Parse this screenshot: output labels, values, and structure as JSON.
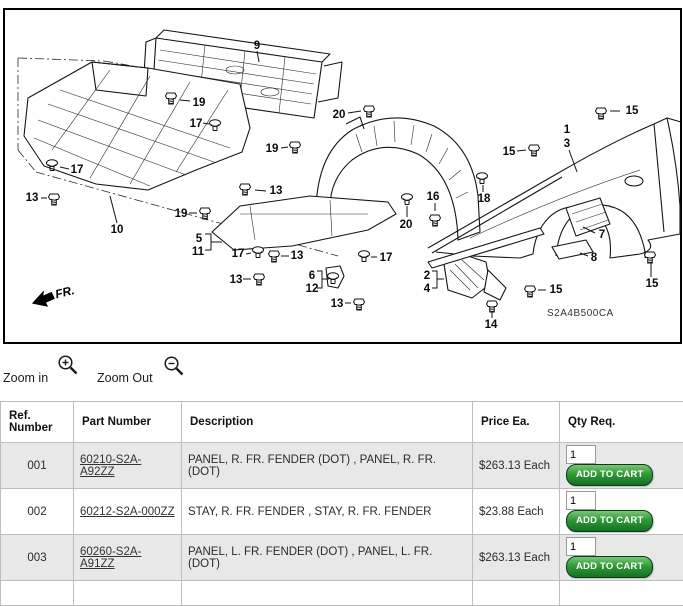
{
  "diagram": {
    "code": "S2A4B500CA",
    "fr_label": "FR.",
    "labels": [
      {
        "t": "9",
        "x": 257,
        "y": 46
      },
      {
        "t": "19",
        "x": 199,
        "y": 103
      },
      {
        "t": "17",
        "x": 196,
        "y": 124
      },
      {
        "t": "19",
        "x": 272,
        "y": 149
      },
      {
        "t": "20",
        "x": 339,
        "y": 115
      },
      {
        "t": "15",
        "x": 632,
        "y": 111
      },
      {
        "t": "15",
        "x": 509,
        "y": 152
      },
      {
        "t": "1",
        "x": 567,
        "y": 130
      },
      {
        "t": "3",
        "x": 567,
        "y": 144
      },
      {
        "t": "13",
        "x": 32,
        "y": 198
      },
      {
        "t": "13",
        "x": 276,
        "y": 191
      },
      {
        "t": "19",
        "x": 181,
        "y": 214
      },
      {
        "t": "10",
        "x": 117,
        "y": 230
      },
      {
        "t": "17",
        "x": 77,
        "y": 170
      },
      {
        "t": "5",
        "x": 199,
        "y": 239
      },
      {
        "t": "11",
        "x": 198,
        "y": 252
      },
      {
        "t": "17",
        "x": 238,
        "y": 254
      },
      {
        "t": "13",
        "x": 297,
        "y": 256
      },
      {
        "t": "13",
        "x": 236,
        "y": 280
      },
      {
        "t": "6",
        "x": 312,
        "y": 276
      },
      {
        "t": "12",
        "x": 312,
        "y": 289
      },
      {
        "t": "13",
        "x": 337,
        "y": 304
      },
      {
        "t": "20",
        "x": 406,
        "y": 225
      },
      {
        "t": "16",
        "x": 433,
        "y": 197
      },
      {
        "t": "18",
        "x": 484,
        "y": 199
      },
      {
        "t": "17",
        "x": 386,
        "y": 258
      },
      {
        "t": "2",
        "x": 427,
        "y": 276
      },
      {
        "t": "4",
        "x": 427,
        "y": 289
      },
      {
        "t": "14",
        "x": 491,
        "y": 325
      },
      {
        "t": "15",
        "x": 556,
        "y": 290
      },
      {
        "t": "15",
        "x": 652,
        "y": 284
      },
      {
        "t": "7",
        "x": 602,
        "y": 235
      },
      {
        "t": "8",
        "x": 594,
        "y": 258
      }
    ],
    "fasteners": [
      {
        "type": "bolt",
        "x": 171,
        "y": 97
      },
      {
        "type": "clip",
        "x": 215,
        "y": 125
      },
      {
        "type": "bolt",
        "x": 295,
        "y": 146
      },
      {
        "type": "bolt",
        "x": 369,
        "y": 110
      },
      {
        "type": "bolt",
        "x": 601,
        "y": 112
      },
      {
        "type": "bolt",
        "x": 534,
        "y": 149
      },
      {
        "type": "bolt",
        "x": 54,
        "y": 198
      },
      {
        "type": "bolt",
        "x": 245,
        "y": 188
      },
      {
        "type": "bolt",
        "x": 205,
        "y": 212
      },
      {
        "type": "clip",
        "x": 52,
        "y": 165
      },
      {
        "type": "clip",
        "x": 258,
        "y": 252
      },
      {
        "type": "bolt",
        "x": 274,
        "y": 255
      },
      {
        "type": "bolt",
        "x": 259,
        "y": 278
      },
      {
        "type": "clip",
        "x": 333,
        "y": 278
      },
      {
        "type": "bolt",
        "x": 359,
        "y": 303
      },
      {
        "type": "clip",
        "x": 407,
        "y": 199
      },
      {
        "type": "bolt",
        "x": 435,
        "y": 219
      },
      {
        "type": "clip",
        "x": 482,
        "y": 178
      },
      {
        "type": "clip",
        "x": 364,
        "y": 256
      },
      {
        "type": "bolt",
        "x": 492,
        "y": 305
      },
      {
        "type": "bolt",
        "x": 530,
        "y": 290
      },
      {
        "type": "bolt",
        "x": 650,
        "y": 256
      }
    ]
  },
  "controls": {
    "zoom_in": "Zoom in",
    "zoom_out": "Zoom Out"
  },
  "table": {
    "headers": [
      "Ref. Number",
      "Part Number",
      "Description",
      "Price Ea.",
      "Qty Req."
    ],
    "button_label": "ADD TO CART",
    "colors": {
      "button_green": "#2f9a37",
      "row_alt": "#e8e8e8"
    },
    "rows": [
      {
        "ref": "001",
        "part_number": "60210-S2A-A92ZZ",
        "description": "PANEL, R. FR. FENDER (DOT) , PANEL, R. FR. (DOT)",
        "price": "$263.13 Each",
        "qty": "1"
      },
      {
        "ref": "002",
        "part_number": "60212-S2A-000ZZ",
        "description": "STAY, R. FR. FENDER , STAY, R. FR. FENDER",
        "price": "$23.88 Each",
        "qty": "1"
      },
      {
        "ref": "003",
        "part_number": "60260-S2A-A91ZZ",
        "description": "PANEL, L. FR. FENDER (DOT) , PANEL, L. FR. (DOT)",
        "price": "$263.13 Each",
        "qty": "1"
      }
    ]
  }
}
